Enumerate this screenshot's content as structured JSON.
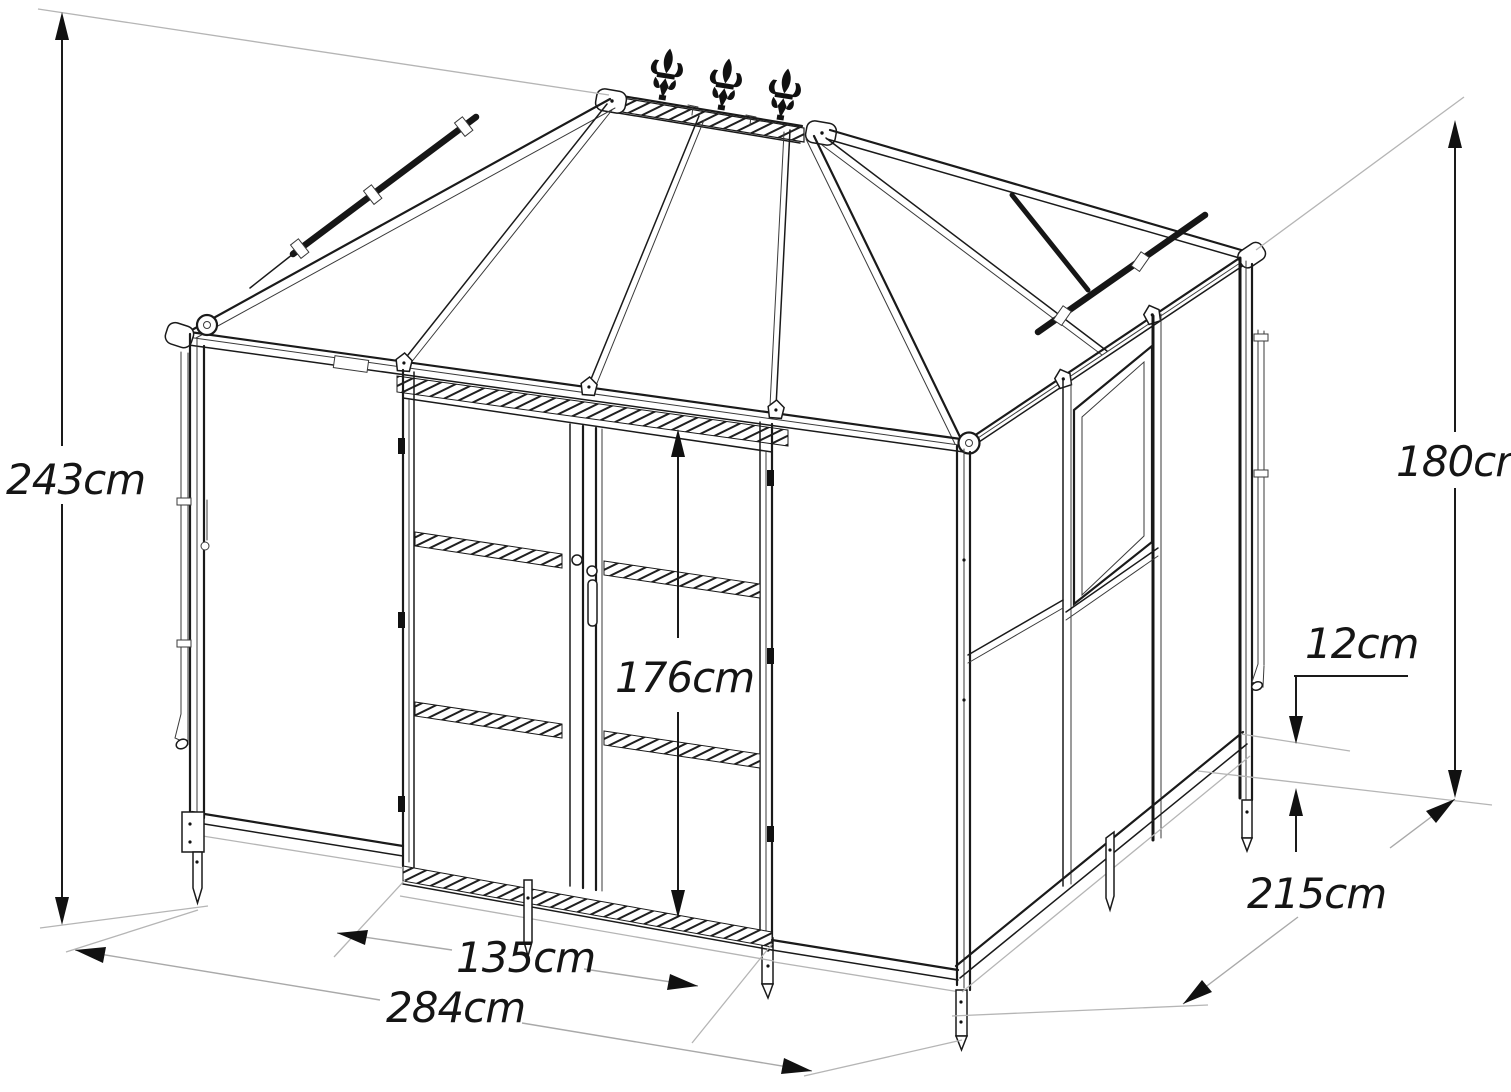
{
  "dimensions": {
    "total_height": "243cm",
    "side_height": "180cm",
    "base_height": "12cm",
    "depth": "215cm",
    "door_width": "135cm",
    "total_width": "284cm",
    "door_height": "176cm"
  }
}
